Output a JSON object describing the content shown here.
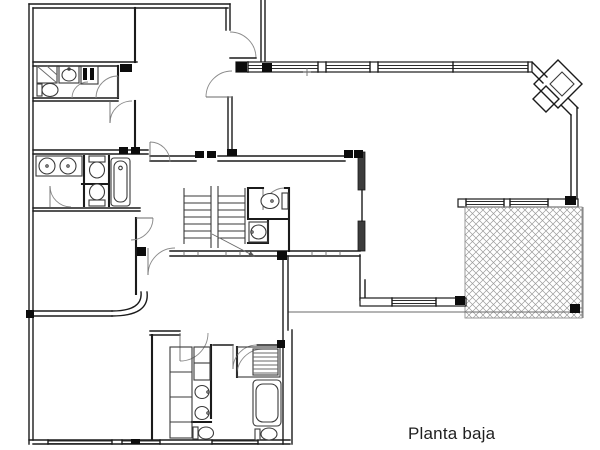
{
  "caption": {
    "text": "Planta baja"
  },
  "colors": {
    "bg": "#ffffff",
    "wall": "#1b1b1b",
    "thin": "#6a6a6a",
    "fixture": "#3a3a3a",
    "glazing": "#2e2e2e",
    "hatch": "#9b9b9b",
    "column": "#0c0c0c",
    "text": "#1f1f1f"
  },
  "fixture_icons": [
    "shower-icon",
    "bathtub-icon",
    "toilet-icon",
    "sink-icon",
    "double-vanity-icon",
    "wardrobe-icon",
    "staircase-icon",
    "door-swing-icon",
    "window-glazing-icon",
    "structural-column-icon",
    "terrace-paving-hatch",
    "corner-pillar-icon",
    "stairs-direction-arrow"
  ]
}
